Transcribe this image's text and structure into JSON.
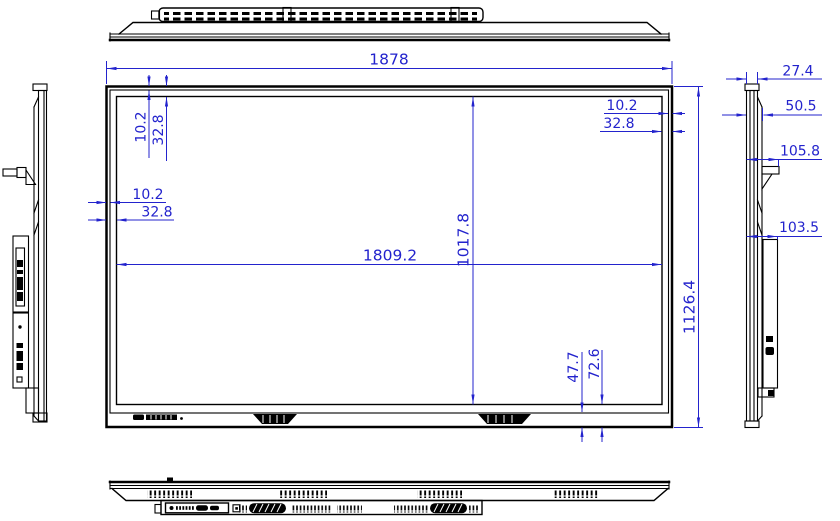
{
  "title": "display-panel-dimension-drawing",
  "units": "mm",
  "colors": {
    "line": "#000000",
    "dimension": "#2323cd",
    "background": "#ffffff"
  },
  "dimensions": {
    "overall": {
      "width": "1878",
      "height": "1126.4"
    },
    "active_area": {
      "width": "1809.2",
      "height": "1017.8"
    },
    "bezel_top": {
      "glass": "10.2",
      "active": "32.8"
    },
    "bezel_right": {
      "glass": "10.2",
      "active": "32.8"
    },
    "bezel_left": {
      "glass": "10.2",
      "active": "32.8"
    },
    "bezel_bottom": {
      "glass": "47.7",
      "active": "72.6"
    },
    "depth": {
      "panel": "27.4",
      "front_section": "50.5",
      "wall_bracket": "105.8",
      "back_box": "103.5"
    }
  }
}
